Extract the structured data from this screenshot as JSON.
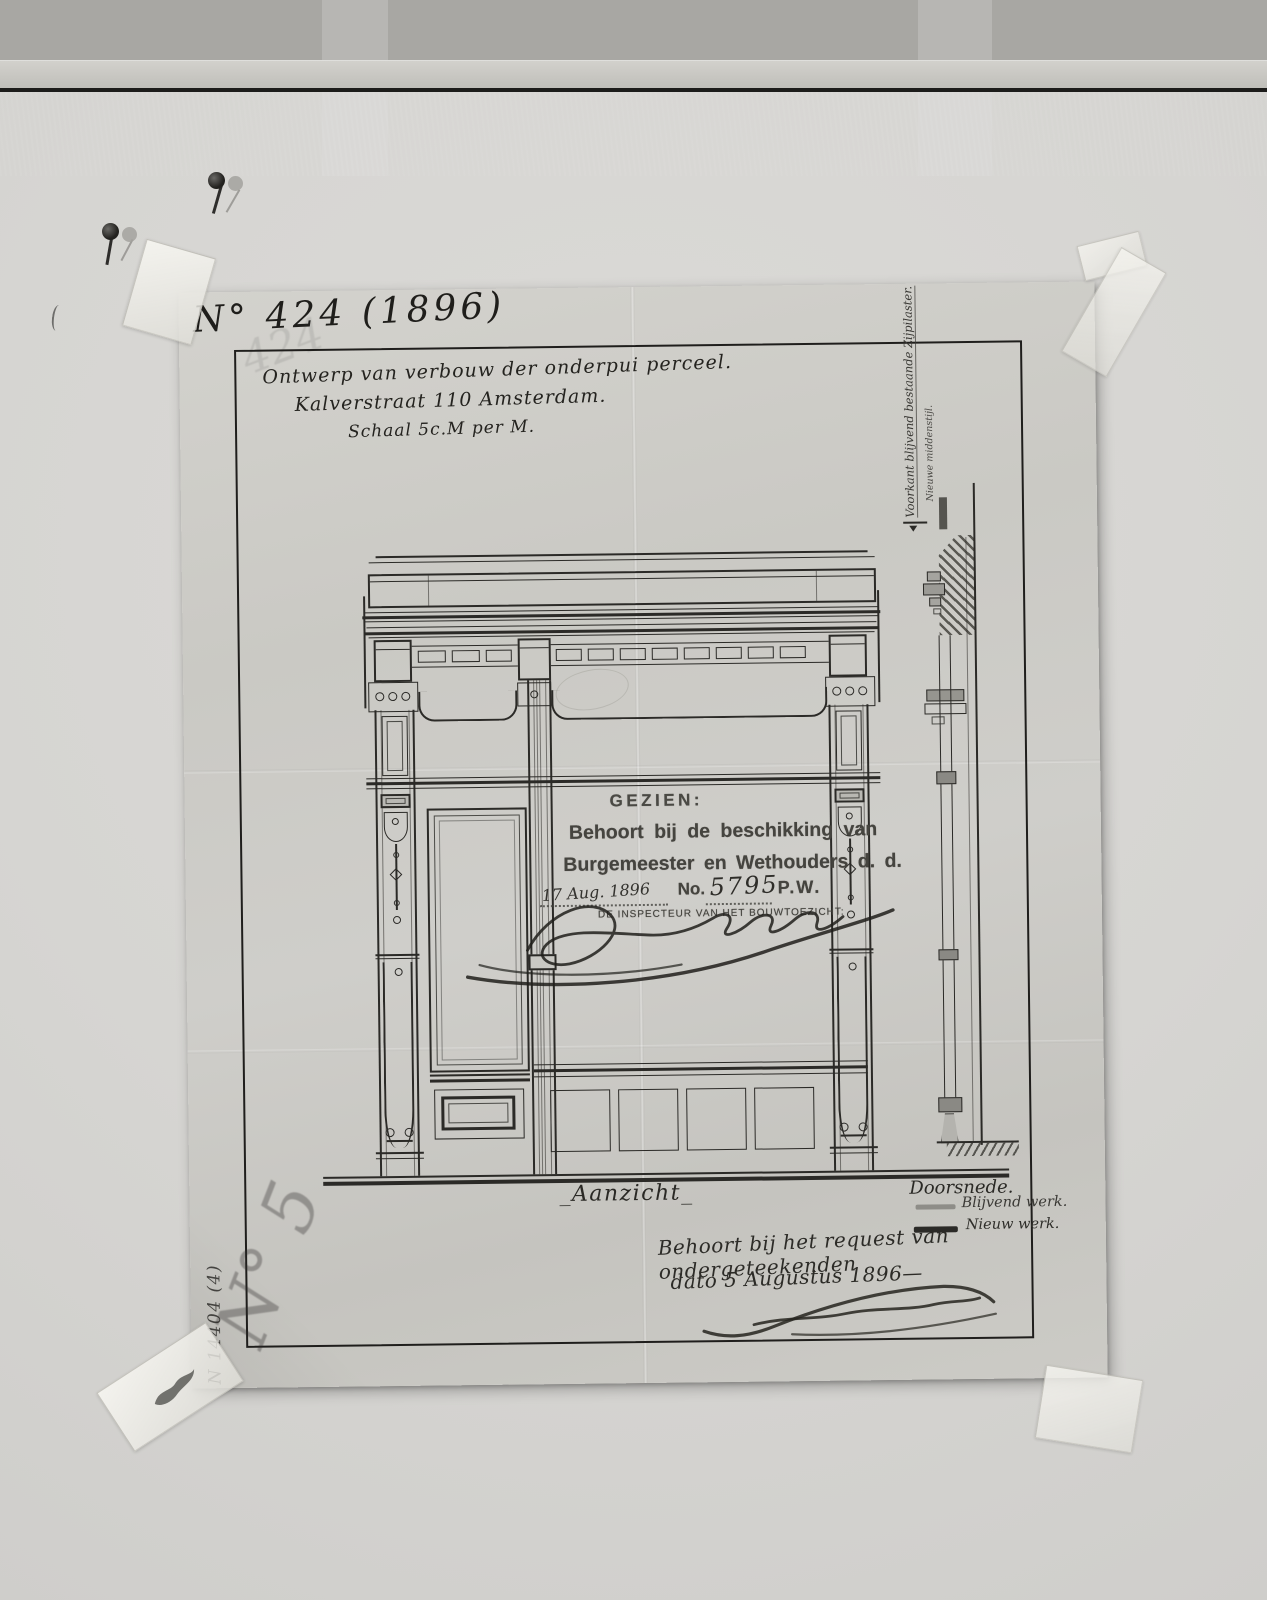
{
  "palette": {
    "mount": "#d6d5d2",
    "paper": "#cbcac5",
    "ink": "#2b2a27",
    "stamp_ink": "#45443f",
    "pencil": "#6f6e6a",
    "wall_dark": "#3d3c38",
    "legend_gray": "#8e8d88"
  },
  "archive": {
    "number": "N° 424 (1896)",
    "ghost_number": "424",
    "pencil_number": "N° 5",
    "ink_number": "N 14404 (4)"
  },
  "title": {
    "line1": "Ontwerp van verbouw der onderpui perceel.",
    "line2": "Kalverstraat 110 Amsterdam.",
    "line3": "Schaal 5c.M per M."
  },
  "stamp": {
    "gezien": "GEZIEN:",
    "line1": "Behoort bij de beschikking van",
    "line2": "Burgemeester en Wethouders d. d.",
    "date": "17 Aug. 1896",
    "no_label": "No.",
    "no_value": "5795",
    "dept": "P.W.",
    "inspector": "DE INSPECTEUR VAN HET BOUWTOEZICHT:"
  },
  "drawing": {
    "elevation_label": "_Aanzicht_",
    "section_label_line1": "Voorkant blijvend bestaande Zijpilaster.",
    "section_label_line2": "Nieuwe middenstijl.",
    "legend_title": "Doorsnede.",
    "legend_items": [
      {
        "label": "Blijvend werk.",
        "color": "#8e8d88"
      },
      {
        "label": "Nieuw werk.",
        "color": "#2b2a27"
      }
    ]
  },
  "note": {
    "line1": "Behoort bij het request van ondergeteekenden",
    "line2": "dato 5 Augustus 1896—"
  }
}
